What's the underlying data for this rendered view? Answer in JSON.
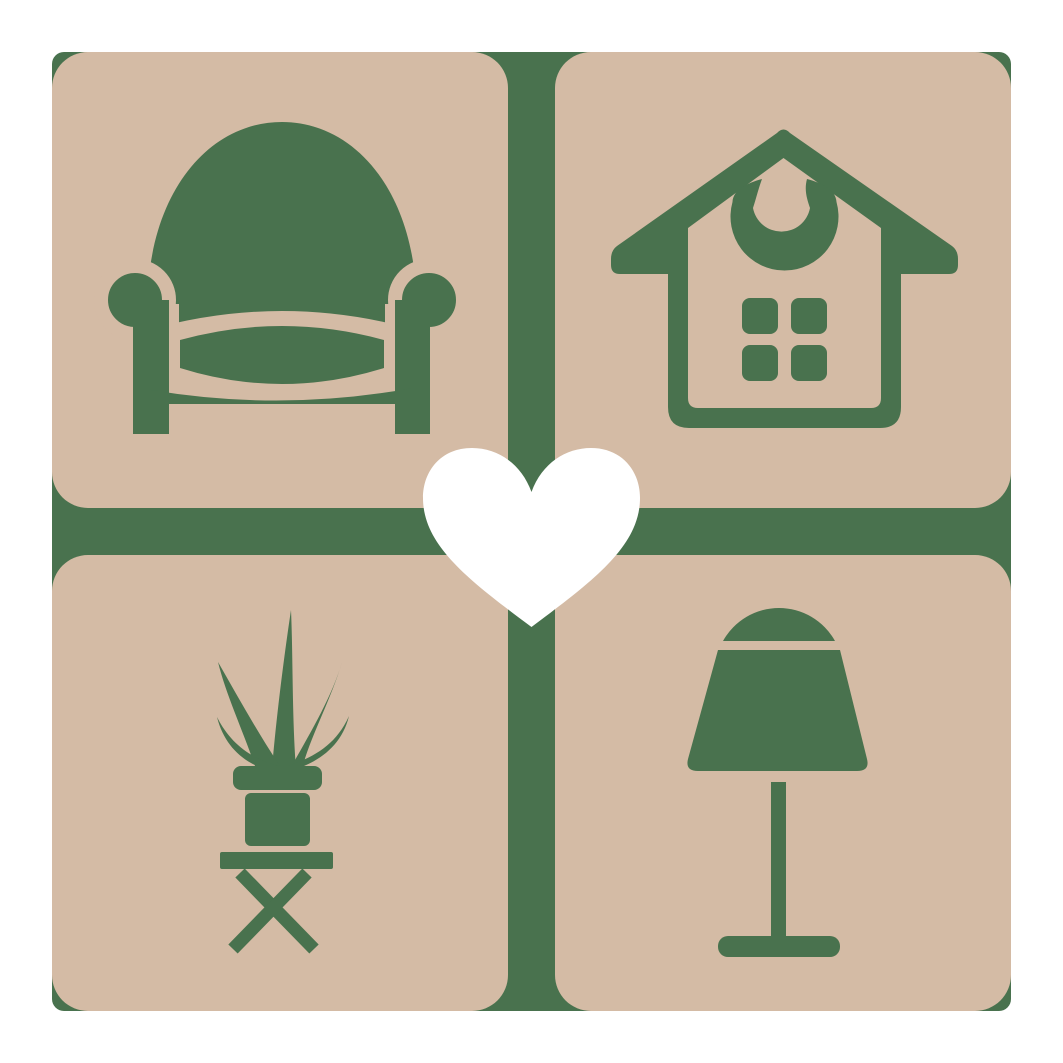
{
  "app": {
    "name": "home-furniture-logo",
    "description": "Square logo: 2x2 grid of tan rounded tiles on a green square, green furniture icons in each tile, white heart at center"
  },
  "palette": {
    "canvas": "#ffffff",
    "tile": "#d4bba5",
    "green": "#49724e",
    "heart": "#ffffff"
  },
  "logo": {
    "grid": {
      "rows": 2,
      "cols": 2
    },
    "tiles": [
      {
        "position": "top-left",
        "icon": "armchair-icon",
        "label": "armchair"
      },
      {
        "position": "top-right",
        "icon": "house-icon",
        "label": "house with window and door-knocker ornament"
      },
      {
        "position": "bottom-left",
        "icon": "potted-plant-icon",
        "label": "potted plant on folding stool"
      },
      {
        "position": "bottom-right",
        "icon": "table-lamp-icon",
        "label": "table lamp"
      }
    ],
    "center": {
      "icon": "heart-icon",
      "label": "heart"
    }
  }
}
